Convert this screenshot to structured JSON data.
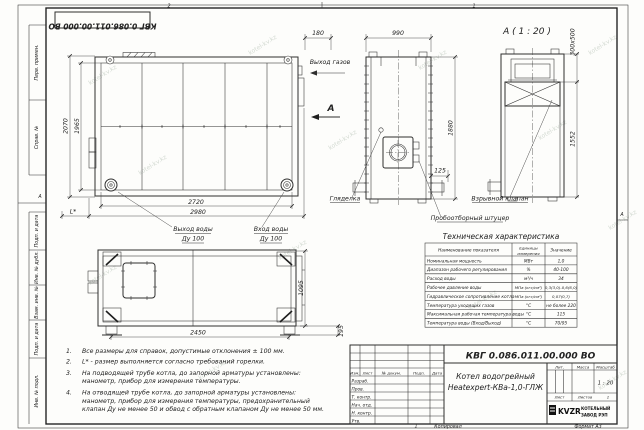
{
  "stamp": {
    "doc_number_top": "КВГ 0.086.011.00.000 ВО"
  },
  "frame": {
    "left_strip": [
      "Перв. примен.",
      "Справ. №",
      "Подп. и дата",
      "Инв. № дубл.",
      "Взам. инв. №",
      "Подп. и дата",
      "Инв. № подл."
    ],
    "zone_left": "А",
    "zone_right": "А",
    "zone_top_1": "2",
    "zone_top_2": "1",
    "zone_bottom": "1"
  },
  "front_view": {
    "dim_height_outer": "2070",
    "dim_height_inner": "1965",
    "dim_width_inner": "2720",
    "dim_width_outer": "2980",
    "dim_l": "L*",
    "label_water_out_1": "Выход воды",
    "label_water_out_2": "Ду 100",
    "label_water_in_1": "Вход воды",
    "label_water_in_2": "Ду 100"
  },
  "side_view": {
    "dim_180": "180",
    "dim_990": "990",
    "dim_1880": "1880",
    "dim_125": "125",
    "label_gas_out": "Выход газов",
    "section_letter": "А",
    "label_sight": "Гляделка",
    "label_sampler": "Пробоотборный штуцер"
  },
  "detail_view": {
    "title": "А ( 1 : 20 )",
    "dim_size": "300х500",
    "dim_1552": "1552",
    "label_valve": "Взрывной клапан"
  },
  "plan_view": {
    "dim_2450": "2450",
    "dim_1095": "1095",
    "dim_195": "195"
  },
  "notes": {
    "lines": [
      {
        "num": "1.",
        "text": "Все размеры для справок, допустимые отклонения ± 100 мм."
      },
      {
        "num": "2.",
        "text": "L* - размер выполняется согласно требований горелки."
      },
      {
        "num": "3.",
        "text": "На подводящей трубе котла, до запорной арматуры установлены:"
      },
      {
        "num": "",
        "text": "манометр, прибор для измерения температуры."
      },
      {
        "num": "4.",
        "text": "На отводящей трубе котла, до запорной арматуры установлены:"
      },
      {
        "num": "",
        "text": "манометр, прибор для измерения температуры, предохранительный"
      },
      {
        "num": "",
        "text": "клапан Ду не менее 50 и обвод с обратным клапаном Ду не менее 50 мм."
      }
    ]
  },
  "spec_table": {
    "title": "Техническая характеристика",
    "col_name": "Наименование показателя",
    "col_units_1": "Единицы",
    "col_units_2": "измерения",
    "col_value": "Значение",
    "rows": [
      {
        "name": "Номинальная мощность",
        "units": "МВт",
        "value": "1,0"
      },
      {
        "name": "Диапазон рабочего регулирования",
        "units": "%",
        "value": "40-100"
      },
      {
        "name": "Расход воды",
        "units": "м³/ч",
        "value": "34"
      },
      {
        "name": "Рабочее давление воды",
        "units": "МПа (кгс/см²)",
        "value": "0,3(3,0)-0,6(6,0)"
      },
      {
        "name": "Гидравлическое сопротивление котла",
        "units": "МПа (кгс/см²)",
        "value": "0,07(0,7)"
      },
      {
        "name": "Температура уходящих газов",
        "units": "°С",
        "value": "не более 220"
      },
      {
        "name": "Максимальная рабочая температура воды",
        "units": "°С",
        "value": "115"
      },
      {
        "name": "Температура воды (Вход/Выход)",
        "units": "°С",
        "value": "70/95"
      }
    ]
  },
  "title_block": {
    "doc_number": "КВГ 0.086.011.00.000 ВО",
    "name_line1": "Котел водогрейный",
    "name_line2": "Heatexpert-КВа-1,0-ГЛЖ",
    "col_izm": "Изм.",
    "col_list": "Лист",
    "col_docnum": "№ докум.",
    "col_podp": "Подп.",
    "col_data": "Дата",
    "rows": [
      "Разраб.",
      "Пров.",
      "Т. контр.",
      "Нач. отд.",
      "Н. контр.",
      "Утв."
    ],
    "lit": "Лит.",
    "massa": "Масса",
    "masshtab": "Масштаб",
    "scale": "1 : 20",
    "list": "Лист",
    "listov": "Листов",
    "listov_value": "1",
    "logo_text": "KVZR",
    "company_1": "КОТЕЛЬНЫЙ",
    "company_2": "ЗАВОД РЭП",
    "copied": "Копировал",
    "format": "Формат А3"
  },
  "watermark": {
    "text": "kotel-kv.kz"
  }
}
